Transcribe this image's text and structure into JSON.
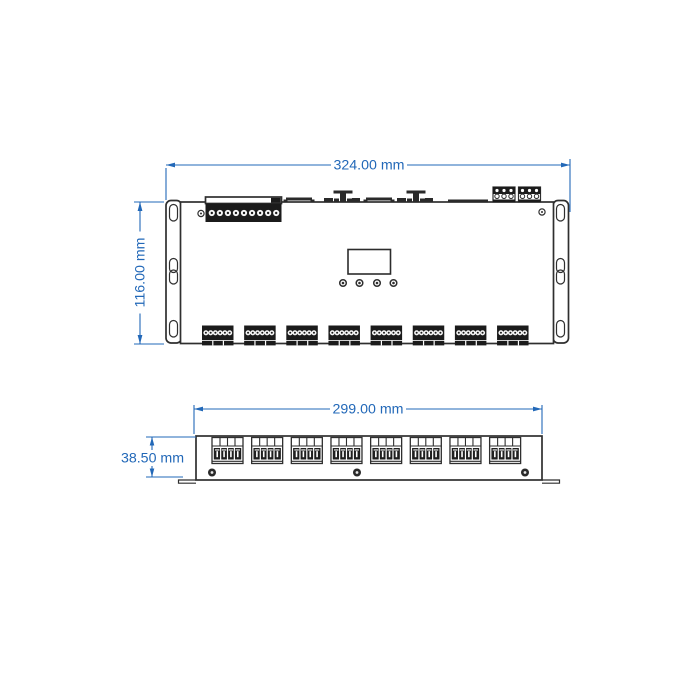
{
  "page": {
    "background": "#ffffff"
  },
  "colors": {
    "dimension": "#2268b8",
    "outline": "#2f2f2f",
    "terminal_dark": "#1b1b1b"
  },
  "top_view": {
    "width_label": "324.00 mm",
    "height_label": "116.00 mm",
    "counts": {
      "output_blocks": 8,
      "pins_per_output_block": 6,
      "input_pins": 9,
      "buttons": 4,
      "top_connectors": 2,
      "pins_per_top_connector": 3,
      "mounting_slots_per_ear": 3,
      "screws": 2
    }
  },
  "front_view": {
    "width_label": "299.00 mm",
    "height_label": "38.50 mm",
    "counts": {
      "terminal_blocks": 8,
      "poles_per_block": 4,
      "screws": 3,
      "feet": 2
    }
  }
}
